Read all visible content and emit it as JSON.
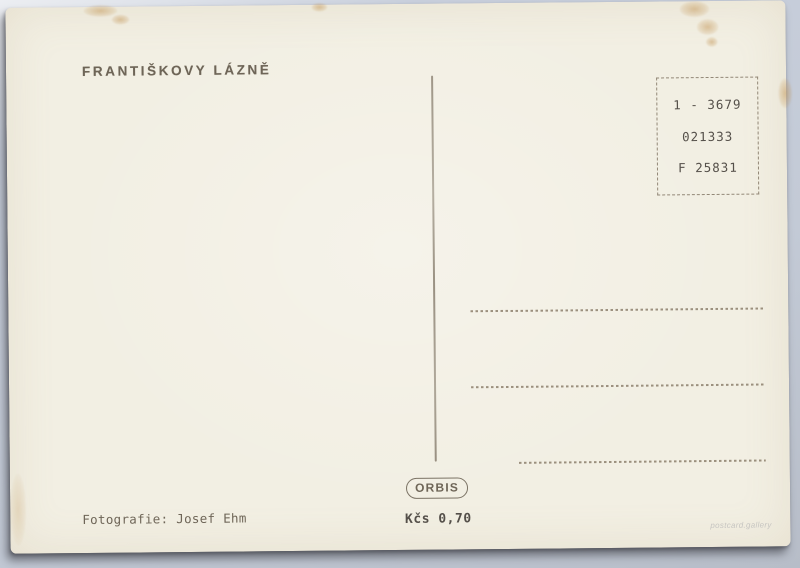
{
  "colors": {
    "card_bg": "#f2efe3",
    "ink": "#6e6557",
    "ink_dark": "#55504a",
    "line": "#9a8e7b",
    "background": "#c8cfdc",
    "watermark": "#c6c5c1"
  },
  "postcard": {
    "title": "FRANTIŠKOVY LÁZNĚ",
    "stamp_box": {
      "line1": "1 - 3679",
      "line2": "021333",
      "line3": "F 25831"
    },
    "publisher_logo": "ORBIS",
    "price": "Kčs 0,70",
    "credit": "Fotografie: Josef Ehm",
    "watermark": "postcard.gallery"
  }
}
